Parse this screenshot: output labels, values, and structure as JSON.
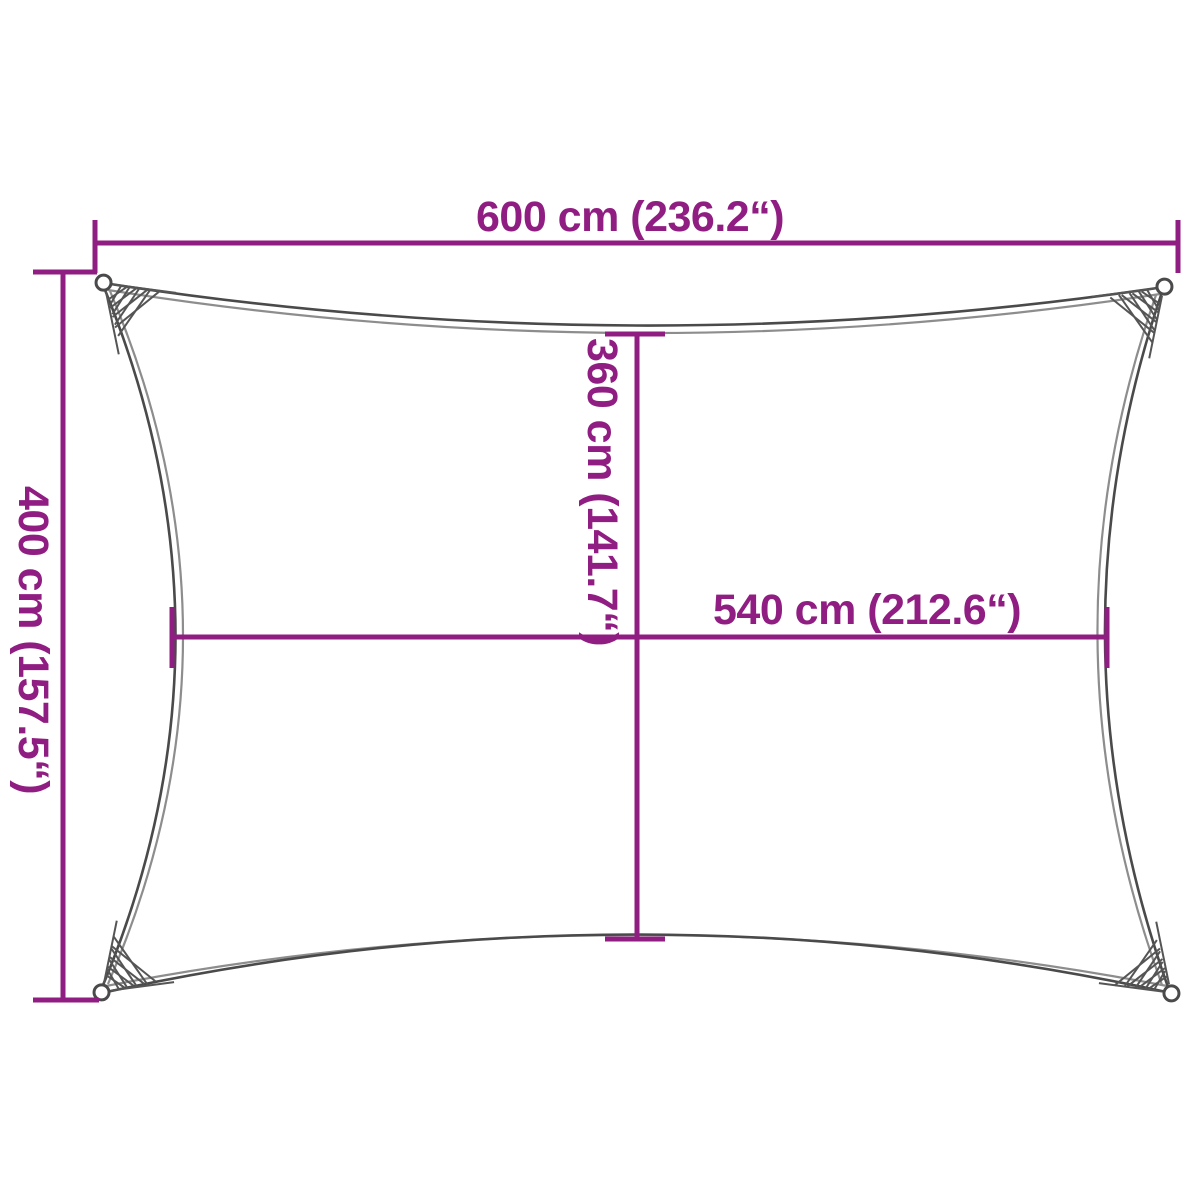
{
  "colors": {
    "accent": "#901d82",
    "outline": "#4a4a4a",
    "background": "#ffffff"
  },
  "dimensions": {
    "top_width": "600 cm (236.2“)",
    "left_height": "400 cm (157.5“)",
    "inner_height": "360 cm (141.7“)",
    "inner_width": "540 cm (212.6“)"
  }
}
